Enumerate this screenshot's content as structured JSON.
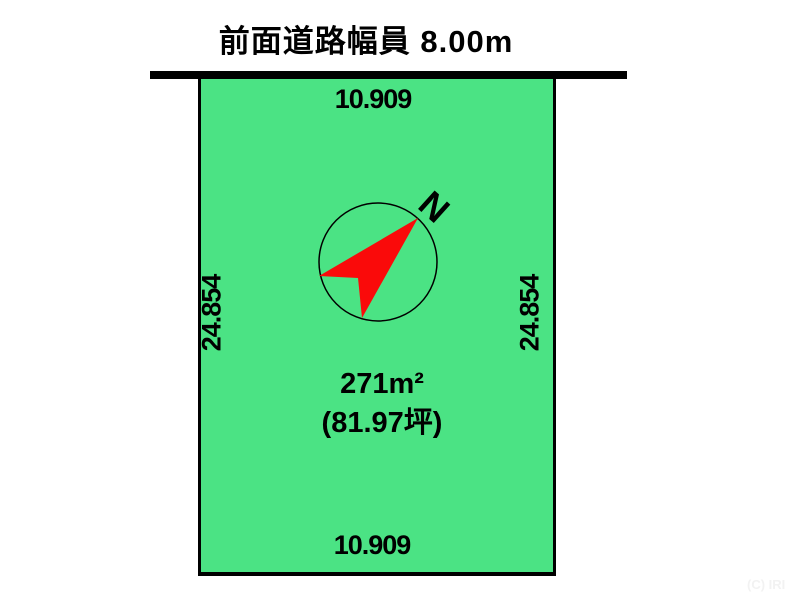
{
  "title": {
    "text": "前面道路幅員 8.00m"
  },
  "road": {
    "line_color": "#000000"
  },
  "plot": {
    "fill_color": "#4BE384",
    "border_color": "#000000",
    "dimensions": {
      "top": "10.909",
      "bottom": "10.909",
      "left": "24.854",
      "right": "24.854"
    },
    "area_sqm": "271m²",
    "area_tsubo": "(81.97坪)"
  },
  "compass": {
    "north_label": "N",
    "arrow_color": "#FA0A0A",
    "ring_color": "#000000"
  },
  "footer": {
    "copyright": "(C) IRI"
  }
}
